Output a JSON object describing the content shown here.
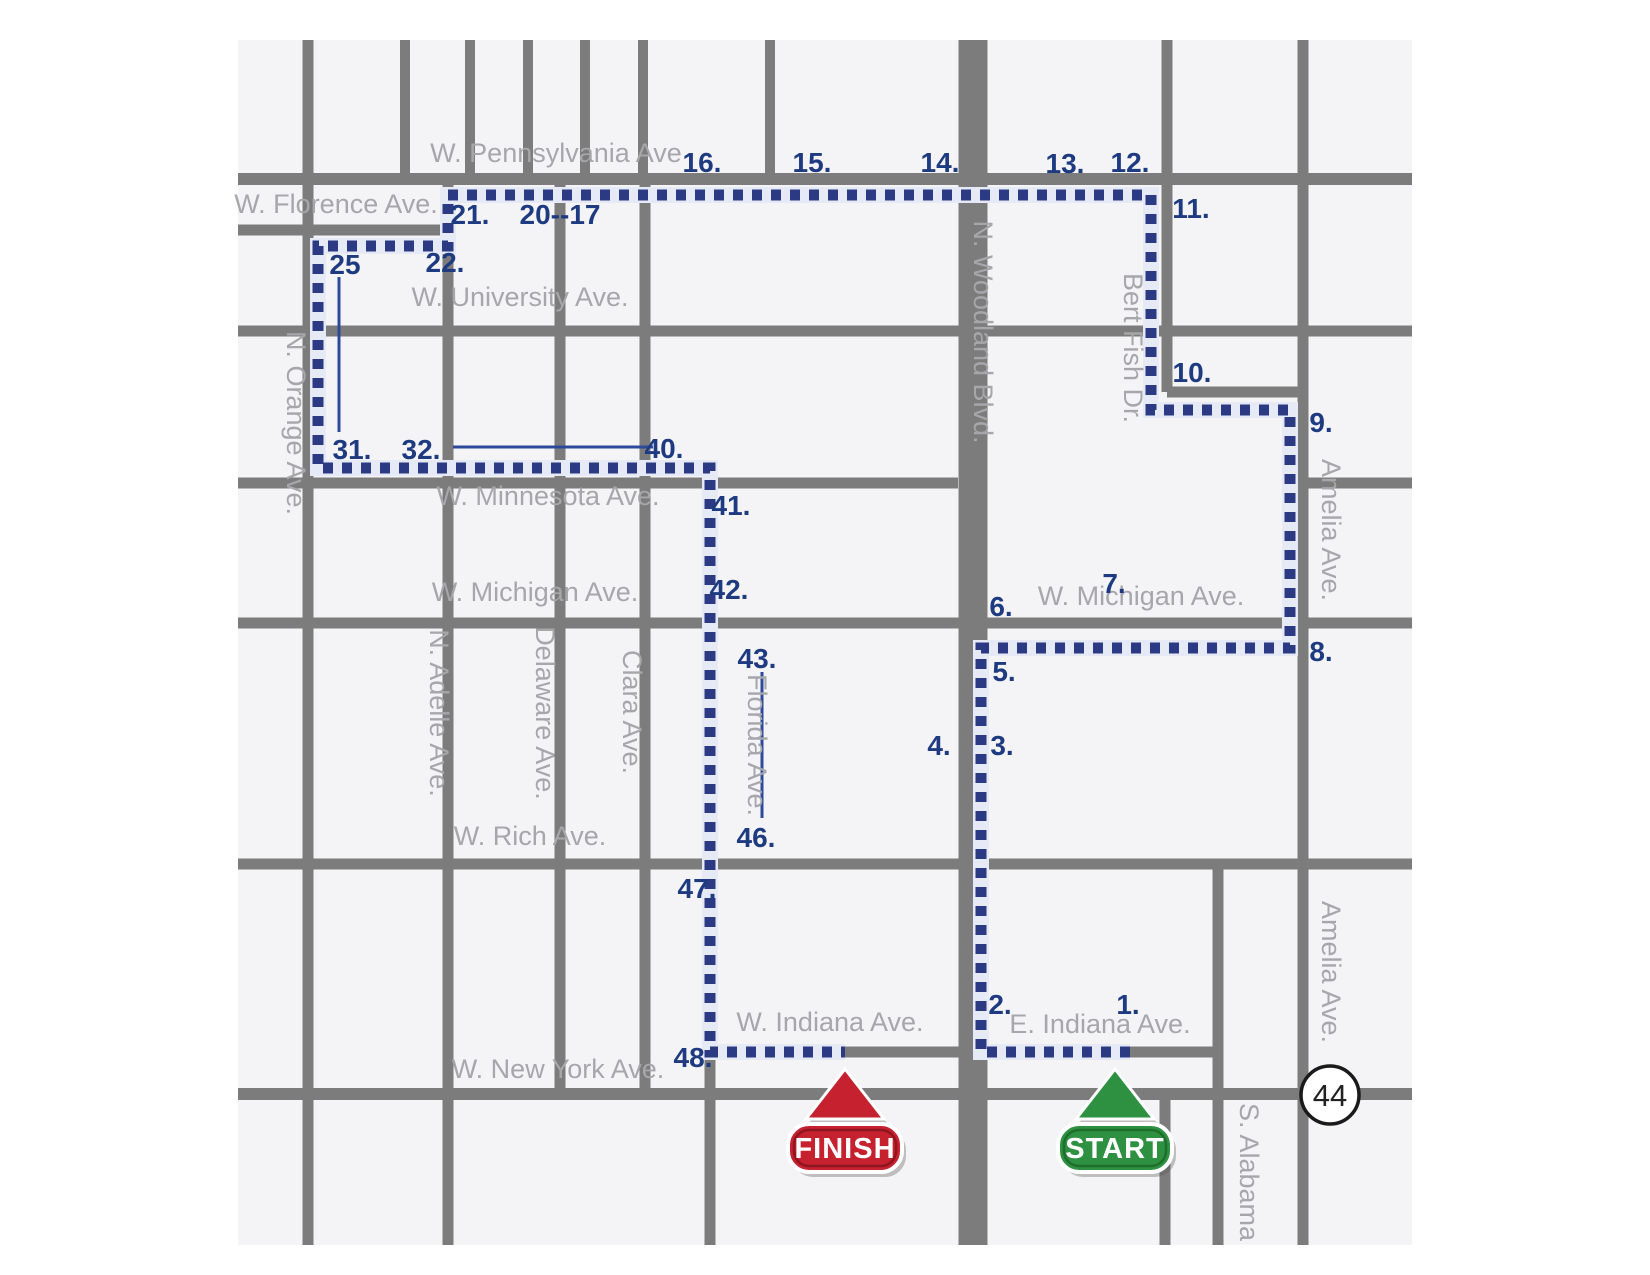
{
  "map": {
    "width": 1650,
    "height": 1275,
    "area": {
      "x": 238,
      "y": 40,
      "w": 1174,
      "h": 1205
    },
    "colors": {
      "page_bg": "#ffffff",
      "block": "#f4f4f6",
      "street": "#7c7c7c",
      "route": "#2b3a82",
      "route_track": "#e6e9f6",
      "street_label": "#a7a7ab",
      "stop_label": "#1e3a80",
      "faded_stop_label": "#c8cdde",
      "leader_line": "#2b4a9b",
      "finish_red": "#c5212f",
      "finish_red_dark": "#8f1520",
      "start_green": "#2e9142",
      "start_green_dark": "#1f6e2e",
      "badge_ring": "#1a1a1a"
    },
    "streets": {
      "horizontal": [
        {
          "name": "W. Pennsylvania Ave",
          "y": 179,
          "x1": 238,
          "x2": 1412,
          "w": 12
        },
        {
          "name": "W. Florence Ave.",
          "y": 230,
          "x1": 238,
          "x2": 454,
          "w": 11
        },
        {
          "name": "W. University Ave.",
          "y": 331,
          "x1": 238,
          "x2": 1412,
          "w": 11
        },
        {
          "name": "Bert Fish cross street",
          "y": 392,
          "x1": 1167,
          "x2": 1303,
          "w": 11
        },
        {
          "name": "W. Minnesota Ave.",
          "y": 483,
          "x1": 238,
          "x2": 958,
          "w": 11
        },
        {
          "name": "Minnesota east segment",
          "y": 483,
          "x1": 1303,
          "x2": 1412,
          "w": 11
        },
        {
          "name": "W. Michigan Ave.",
          "y": 623,
          "x1": 238,
          "x2": 1412,
          "w": 11
        },
        {
          "name": "W. Rich Ave.",
          "y": 864,
          "x1": 238,
          "x2": 1412,
          "w": 11
        },
        {
          "name": "Indiana Ave.",
          "y": 1052,
          "x1": 710,
          "x2": 1218,
          "w": 11
        },
        {
          "name": "W. New York Ave.",
          "y": 1094,
          "x1": 238,
          "x2": 1412,
          "w": 12
        }
      ],
      "vertical": [
        {
          "name": "N. Orange Ave.",
          "x": 308,
          "y1": 40,
          "y2": 1245,
          "w": 11
        },
        {
          "name": "top street 1",
          "x": 405,
          "y1": 40,
          "y2": 179,
          "w": 10
        },
        {
          "name": "top street 2",
          "x": 470,
          "y1": 40,
          "y2": 179,
          "w": 10
        },
        {
          "name": "top street 3",
          "x": 528,
          "y1": 40,
          "y2": 179,
          "w": 10
        },
        {
          "name": "top street 4",
          "x": 585,
          "y1": 40,
          "y2": 179,
          "w": 10
        },
        {
          "name": "top street 5",
          "x": 643,
          "y1": 40,
          "y2": 179,
          "w": 10
        },
        {
          "name": "top street 6",
          "x": 770,
          "y1": 40,
          "y2": 179,
          "w": 10
        },
        {
          "name": "N. Adelle Ave.",
          "x": 448,
          "y1": 179,
          "y2": 1245,
          "w": 11
        },
        {
          "name": "Delaware Ave.",
          "x": 560,
          "y1": 179,
          "y2": 1094,
          "w": 11
        },
        {
          "name": "Clara Ave.",
          "x": 645,
          "y1": 179,
          "y2": 1094,
          "w": 11
        },
        {
          "name": "Florida Ave.",
          "x": 710,
          "y1": 483,
          "y2": 1245,
          "w": 11
        },
        {
          "name": "N. Woodland Blvd.",
          "x": 973,
          "y1": 40,
          "y2": 1245,
          "w": 29
        },
        {
          "name": "Bert Fish Dr.",
          "x": 1167,
          "y1": 40,
          "y2": 392,
          "w": 11
        },
        {
          "name": "south street",
          "x": 1165,
          "y1": 1094,
          "y2": 1245,
          "w": 11
        },
        {
          "name": "S. Alabama",
          "x": 1218,
          "y1": 864,
          "y2": 1245,
          "w": 11
        },
        {
          "name": "Amelia Ave.",
          "x": 1303,
          "y1": 40,
          "y2": 1245,
          "w": 11
        }
      ]
    },
    "street_labels": [
      {
        "text": "W. Pennsylvania Ave",
        "x": 556,
        "y": 162,
        "vertical": false
      },
      {
        "text": "W. Florence Ave.",
        "x": 336,
        "y": 213,
        "vertical": false
      },
      {
        "text": "W. University Ave.",
        "x": 520,
        "y": 306,
        "vertical": false
      },
      {
        "text": "W. Minnesota Ave.",
        "x": 548,
        "y": 505,
        "vertical": false
      },
      {
        "text": "W. Michigan Ave.",
        "x": 535,
        "y": 601,
        "vertical": false
      },
      {
        "text": "W. Michigan Ave.",
        "x": 1141,
        "y": 605,
        "vertical": false
      },
      {
        "text": "W. Rich Ave.",
        "x": 530,
        "y": 845,
        "vertical": false
      },
      {
        "text": "W. Indiana Ave.",
        "x": 830,
        "y": 1031,
        "vertical": false
      },
      {
        "text": "E. Indiana Ave.",
        "x": 1100,
        "y": 1033,
        "vertical": false
      },
      {
        "text": "W. New York Ave.",
        "x": 558,
        "y": 1078,
        "vertical": false
      },
      {
        "text": "N. Orange Ave.",
        "x": 287,
        "y": 423,
        "vertical": true
      },
      {
        "text": "N. Adelle Ave.",
        "x": 430,
        "y": 713,
        "vertical": true
      },
      {
        "text": "Delaware Ave.",
        "x": 536,
        "y": 713,
        "vertical": true
      },
      {
        "text": "Clara Ave.",
        "x": 623,
        "y": 712,
        "vertical": true
      },
      {
        "text": "Florida Ave.",
        "x": 748,
        "y": 745,
        "vertical": true
      },
      {
        "text": "Bert Fish Dr.",
        "x": 1124,
        "y": 348,
        "vertical": true
      },
      {
        "text": "Amelia Ave.",
        "x": 1322,
        "y": 530,
        "vertical": true
      },
      {
        "text": "Amelia Ave.",
        "x": 1322,
        "y": 972,
        "vertical": true
      },
      {
        "text": "S. Alabama",
        "x": 1240,
        "y": 1172,
        "vertical": true
      },
      {
        "text": "N. Woodland Blvd.",
        "x": 974,
        "y": 332,
        "vertical": true,
        "color": "#ffffff"
      }
    ],
    "route": {
      "points": [
        [
          1130,
          1052
        ],
        [
          981,
          1052
        ],
        [
          981,
          648
        ],
        [
          1290,
          648
        ],
        [
          1290,
          410
        ],
        [
          1151,
          410
        ],
        [
          1151,
          195
        ],
        [
          448,
          195
        ],
        [
          448,
          246
        ],
        [
          318,
          246
        ],
        [
          318,
          468
        ],
        [
          710,
          468
        ],
        [
          710,
          1052
        ],
        [
          845,
          1052
        ]
      ],
      "dash": 10,
      "gap": 9,
      "width": 11,
      "track_width": 16
    },
    "stops": [
      {
        "label": "1.",
        "x": 1128,
        "y": 1004
      },
      {
        "label": "2.",
        "x": 1000,
        "y": 1004
      },
      {
        "label": "3.",
        "x": 1002,
        "y": 745
      },
      {
        "label": "4.",
        "x": 939,
        "y": 745
      },
      {
        "label": "5.",
        "x": 1004,
        "y": 671
      },
      {
        "label": "6.",
        "x": 1001,
        "y": 606
      },
      {
        "label": "7.",
        "x": 1114,
        "y": 583
      },
      {
        "label": "8.",
        "x": 1321,
        "y": 651
      },
      {
        "label": "9.",
        "x": 1321,
        "y": 422
      },
      {
        "label": "10.",
        "x": 1192,
        "y": 372
      },
      {
        "label": "11.",
        "x": 1191,
        "y": 208
      },
      {
        "label": "12.",
        "x": 1130,
        "y": 162
      },
      {
        "label": "13.",
        "x": 1065,
        "y": 163
      },
      {
        "label": "14.",
        "x": 940,
        "y": 162
      },
      {
        "label": "15.",
        "x": 812,
        "y": 162
      },
      {
        "label": "16.",
        "x": 702,
        "y": 162
      },
      {
        "label": "20--17",
        "x": 560,
        "y": 214
      },
      {
        "label": "21.",
        "x": 470,
        "y": 214
      },
      {
        "label": "22.",
        "x": 445,
        "y": 262,
        "faded": true
      },
      {
        "label": "25",
        "x": 345,
        "y": 264
      },
      {
        "label": "31.",
        "x": 352,
        "y": 449
      },
      {
        "label": "32.",
        "x": 421,
        "y": 449
      },
      {
        "label": "40.",
        "x": 664,
        "y": 448
      },
      {
        "label": "41.",
        "x": 731,
        "y": 505
      },
      {
        "label": "42.",
        "x": 729,
        "y": 589
      },
      {
        "label": "43.",
        "x": 757,
        "y": 658
      },
      {
        "label": "46.",
        "x": 756,
        "y": 837
      },
      {
        "label": "47.",
        "x": 697,
        "y": 888
      },
      {
        "label": "48.",
        "x": 693,
        "y": 1057
      }
    ],
    "leader_lines": [
      {
        "name": "stop-25-leader",
        "x1": 339,
        "y1": 277,
        "x2": 339,
        "y2": 432
      },
      {
        "name": "stop-32-40-leader",
        "x1": 453,
        "y1": 447,
        "x2": 653,
        "y2": 447
      },
      {
        "name": "stop-43-46-leader",
        "x1": 762,
        "y1": 672,
        "x2": 762,
        "y2": 818
      }
    ],
    "markers": {
      "finish": {
        "label": "FINISH",
        "x": 845
      },
      "start": {
        "label": "START",
        "x": 1115
      },
      "triangle_top_y": 1069,
      "triangle_base_y": 1119,
      "triangle_half_w": 39,
      "sign_y": 1124,
      "sign_w": 114,
      "sign_h": 48,
      "sign_rx": 21
    },
    "badge": {
      "text": "44",
      "x": 1330,
      "y": 1095,
      "r": 29
    }
  }
}
